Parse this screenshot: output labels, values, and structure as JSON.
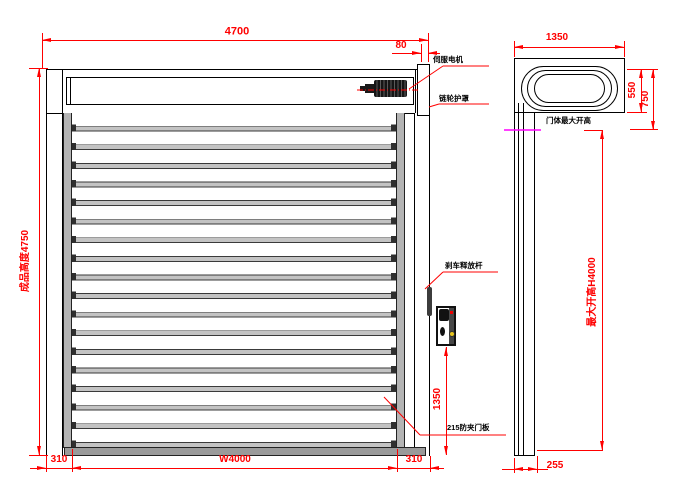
{
  "drawing": {
    "front_view": {
      "dim_total_width": "4700",
      "dim_motor_ext": "80",
      "dim_total_height": "成品高度4750",
      "dim_left_col": "310",
      "dim_opening_width": "W4000",
      "dim_right_col": "310",
      "dim_controller_height": "1350",
      "label_servo": "伺服电机",
      "label_chain_cover": "链轮护罩",
      "label_brake": "刹车释放杆",
      "label_panel": "215防夹门板"
    },
    "side_view": {
      "dim_width": "1350",
      "dim_roll": "550",
      "dim_header": "750",
      "dim_max_open": "最大开高H4000",
      "dim_base_depth": "255",
      "label_open_height_line": "门体最大开高"
    },
    "colors": {
      "dimension_red": "#ff0000",
      "open_height_magenta": "#ff00ff",
      "rail_gray": "#b4b4b4",
      "bottom_bar_gray": "#9a9a9a",
      "button_yellow": "#e8c51e"
    }
  }
}
